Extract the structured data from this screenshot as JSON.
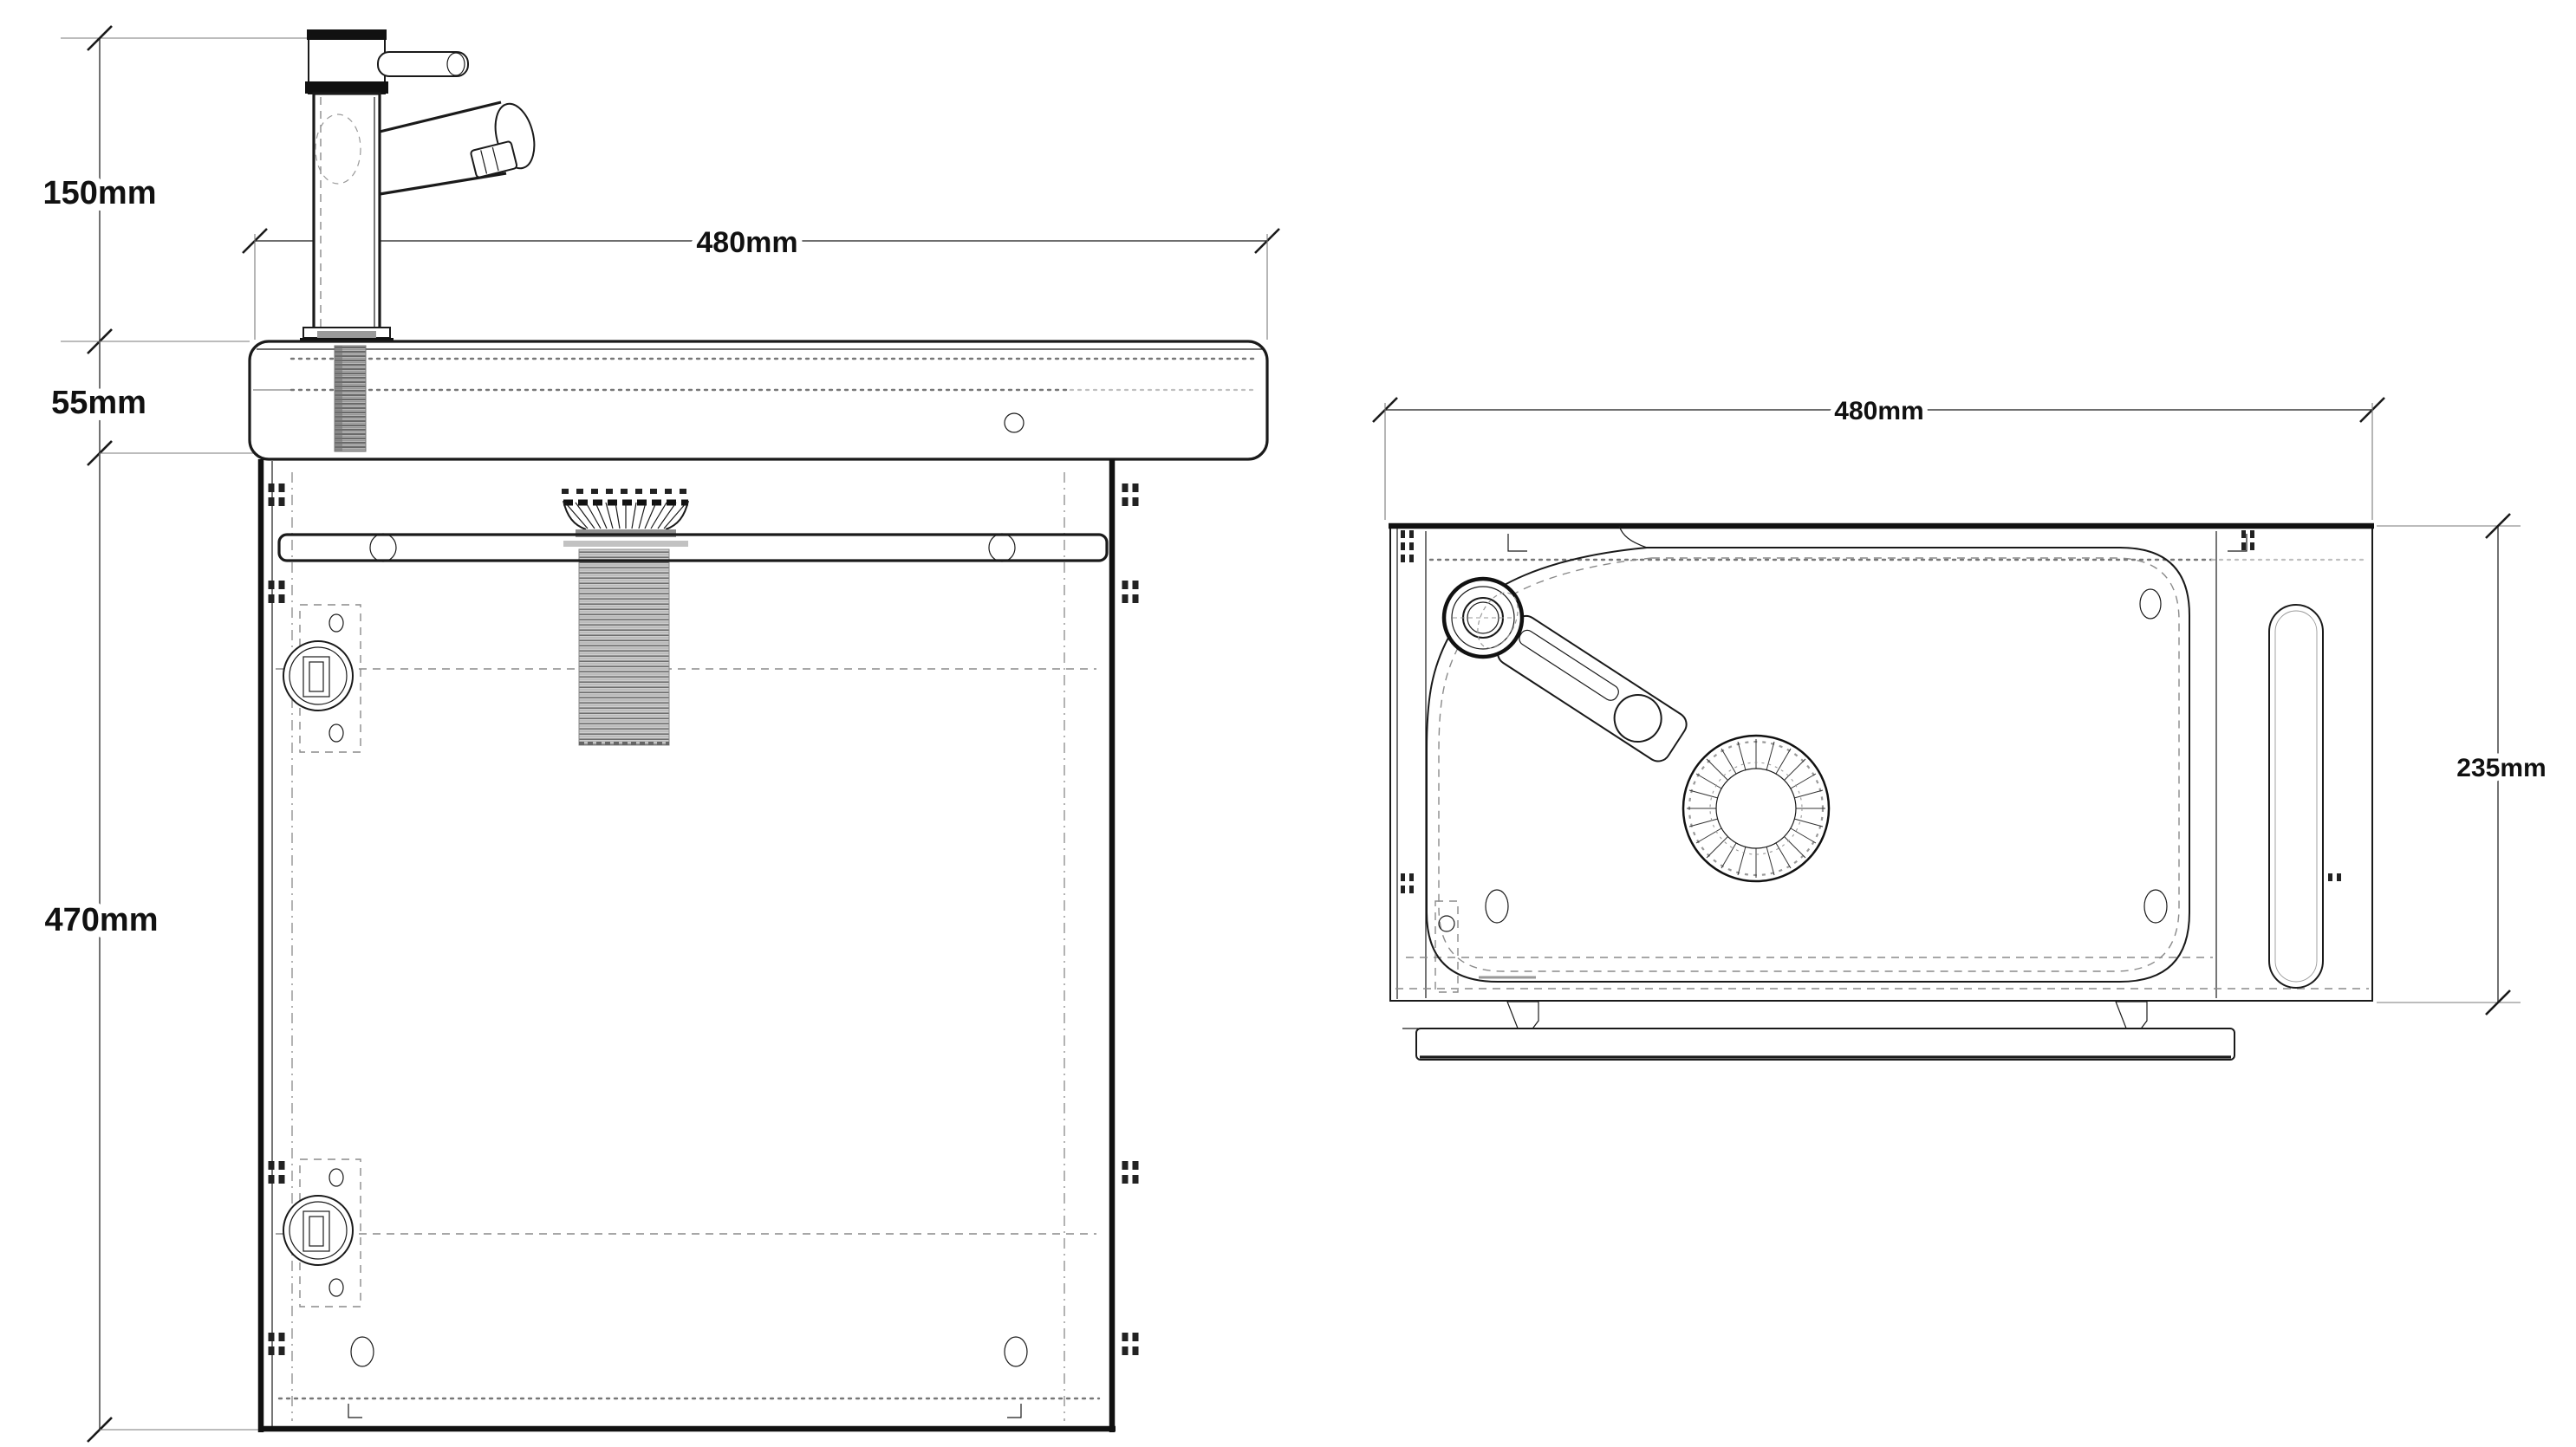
{
  "drawing": {
    "front_view": {
      "tap_height": "150mm",
      "basin_thickness": "55mm",
      "cabinet_height": "470mm",
      "overall_width": "480mm"
    },
    "plan_view": {
      "overall_width": "480mm",
      "overall_depth": "235mm"
    }
  },
  "colors": {
    "line": "#1a1a1a",
    "dimension_line": "#5a5a5a",
    "hidden_detail": "#8a8a8a",
    "background": "#ffffff"
  }
}
